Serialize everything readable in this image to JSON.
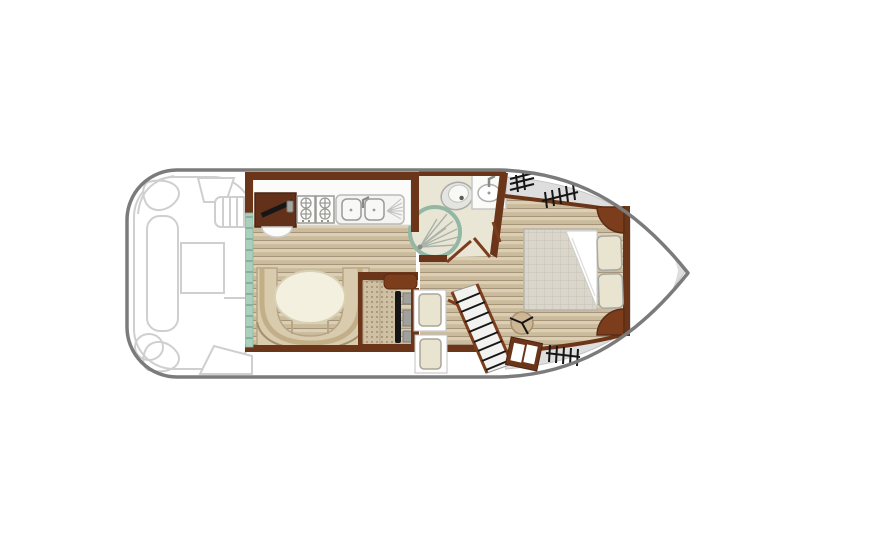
{
  "image": {
    "kind": "boat-floorplan",
    "description": "Top-down deck plan of a canal cruiser with aft deck, saloon-galley, shower room, corridor and bow double cabin. No text labels are rendered in the image.",
    "orientation": "stern-left bow-right"
  },
  "palette": {
    "background": "#ffffff",
    "hull_outline": "#7b7b7b",
    "deck_sketch": "#cccccc",
    "wall_brown": "#6b3519",
    "cabinet_brown": "#7c3d1d",
    "wood_light": "#dccfb4",
    "wood_dark": "#cbbb9d",
    "bathroom_floor": "#eae6d5",
    "deck_gray": "#dedede",
    "sliding_door_teal": "#aacfbc",
    "sofa_tan": "#d8cbae",
    "table_cream": "#f4f0df",
    "mattress_gray": "#dad6cb",
    "pillow_cream": "#e9e4cf",
    "shower_ring": "#92b7a4",
    "rail_black": "#161616"
  },
  "vessel": {
    "stern_deck": {
      "label": "aft deck",
      "furniture": [
        "corner seat port",
        "corner seat starboard",
        "side bench",
        "deck table",
        "aft bench",
        "boarding steps"
      ]
    },
    "saloon": {
      "label": "saloon and galley",
      "furniture": [
        "galley cabinet",
        "four burner hob",
        "double sink with drainer",
        "u-shaped dinette sofa",
        "oval dinette table",
        "inside helm station",
        "sliding patio door"
      ]
    },
    "shower_room": {
      "label": "shower room",
      "fixtures": [
        "marine toilet",
        "washbasin with tap",
        "circular shower cubicle",
        "hinged door"
      ]
    },
    "corridor": {
      "label": "corridor",
      "furniture": [
        "companionway door panels",
        "diagonal side-deck staircase",
        "step box with hatch"
      ]
    },
    "bow_cabin": {
      "label": "bow double cabin",
      "furniture": [
        "double bed with folded sheet",
        "two pillows",
        "round stool",
        "corner lockers"
      ]
    },
    "bow_deck": {
      "label": "bow and side decks",
      "features": [
        "guardrail symbol port aft",
        "guardrail symbol port forward",
        "guardrail symbol starboard"
      ]
    },
    "counts": {
      "burners": 4,
      "sink_basins": 2,
      "pillows": 2,
      "guardrail_symbols": 3,
      "stair_treads": 8
    }
  }
}
